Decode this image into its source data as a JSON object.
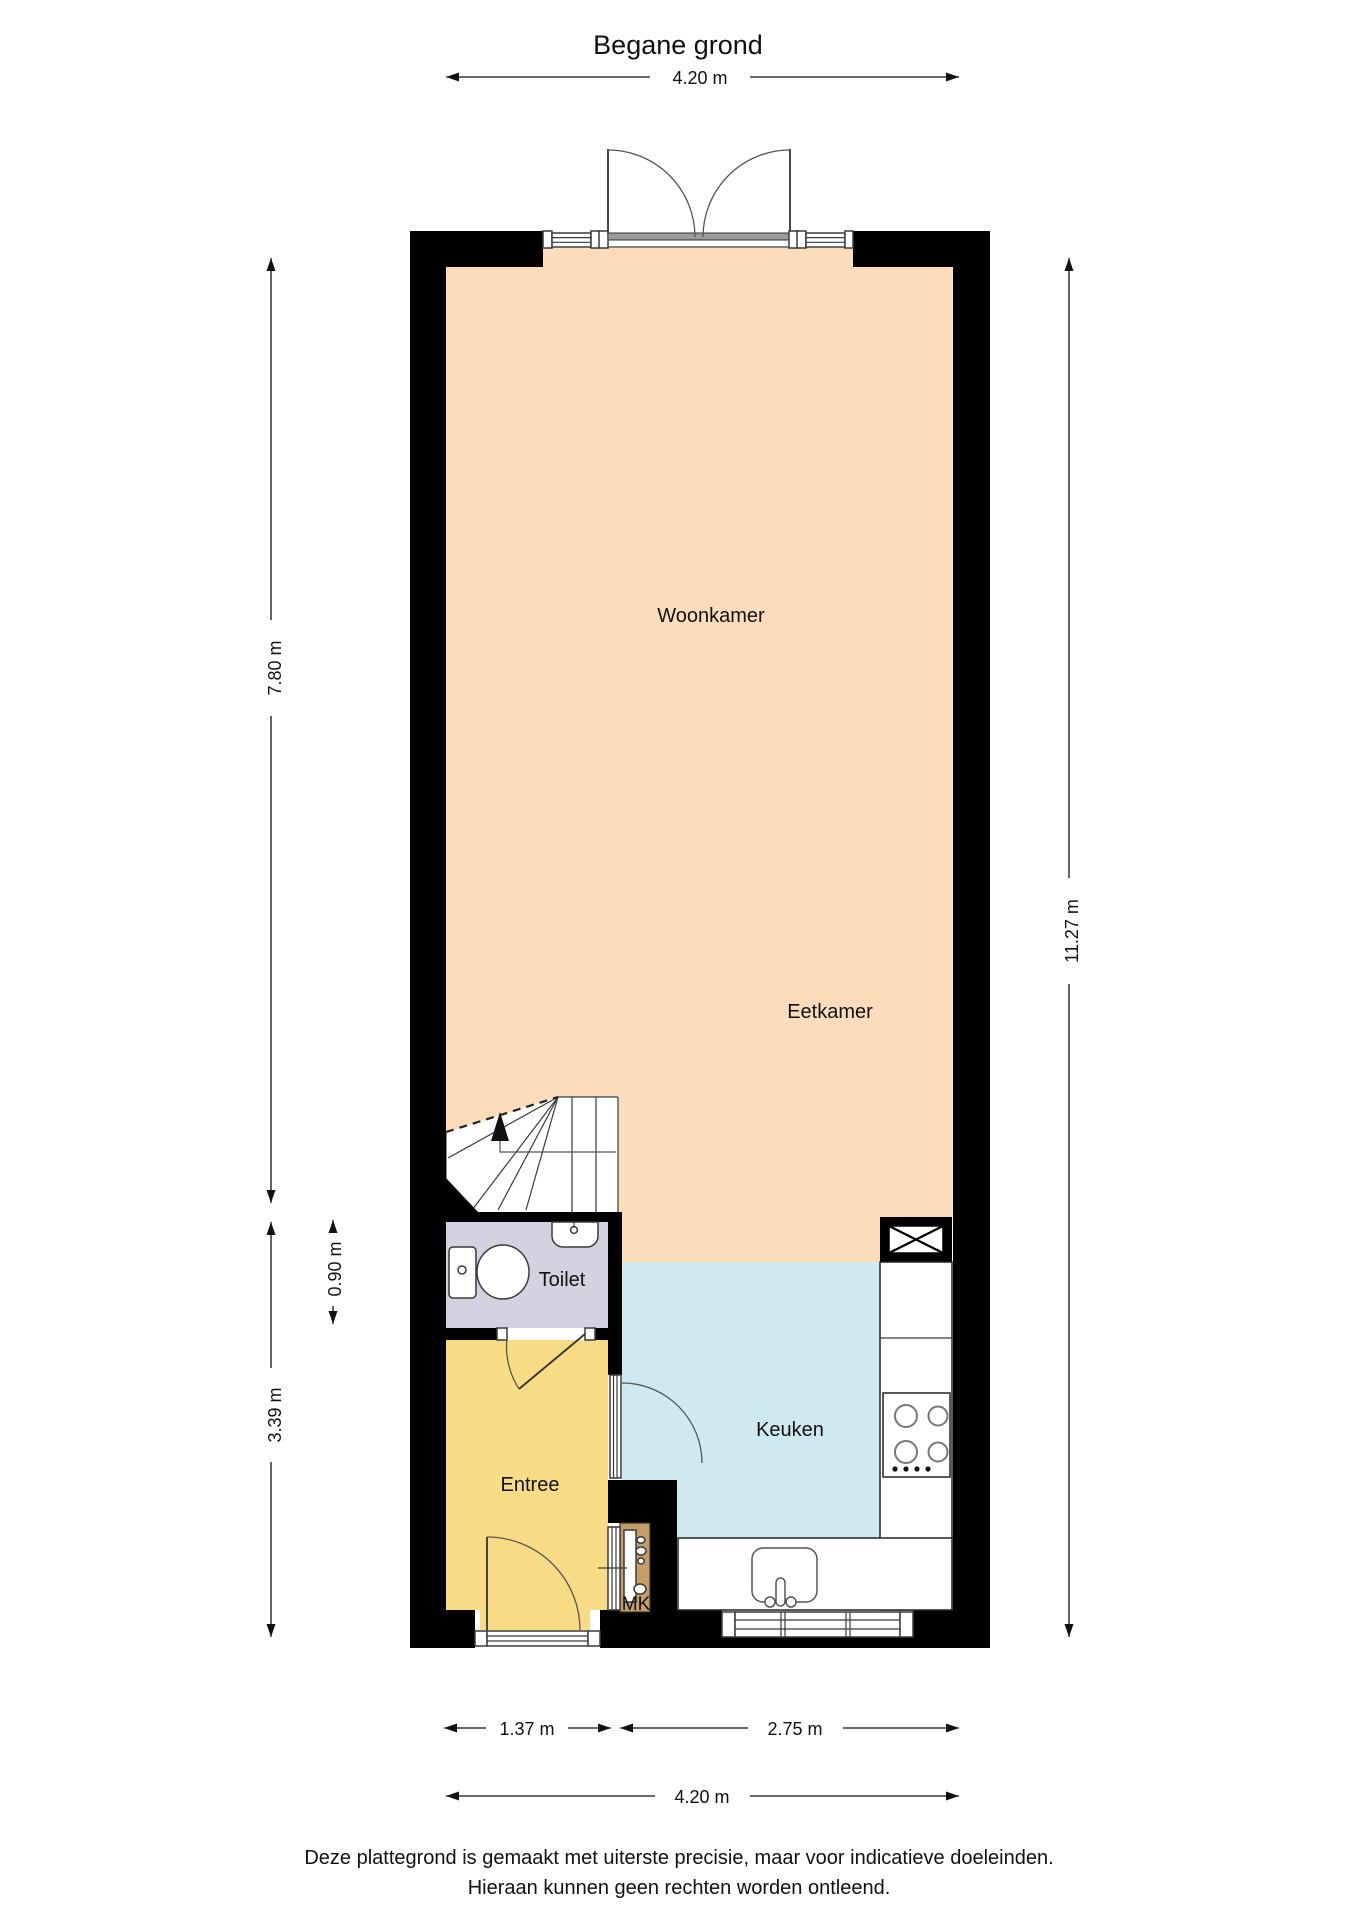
{
  "title": "Begane grond",
  "rooms": {
    "woonkamer": "Woonkamer",
    "eetkamer": "Eetkamer",
    "toilet": "Toilet",
    "entree": "Entree",
    "keuken": "Keuken",
    "mk": "MK"
  },
  "dimensions": {
    "top_width": "4.20 m",
    "left_height_upper": "7.80 m",
    "left_toilet_height": "0.90 m",
    "left_height_lower": "3.39 m",
    "right_height_total": "11.27 m",
    "bottom_width_left": "1.37 m",
    "bottom_width_right": "2.75 m",
    "bottom_width_total": "4.20 m"
  },
  "disclaimer": {
    "line1": "Deze plattegrond is gemaakt met uiterste precisie, maar voor indicatieve doeleinden.",
    "line2": "Hieraan kunnen geen rechten worden ontleend."
  },
  "colors": {
    "living_dining": "#fcdcba",
    "kitchen": "#cfe9f1",
    "toilet_room": "#d2d2e0",
    "entree_room": "#f8dc85",
    "meter_closet": "#c59d66",
    "wall": "#000000"
  }
}
